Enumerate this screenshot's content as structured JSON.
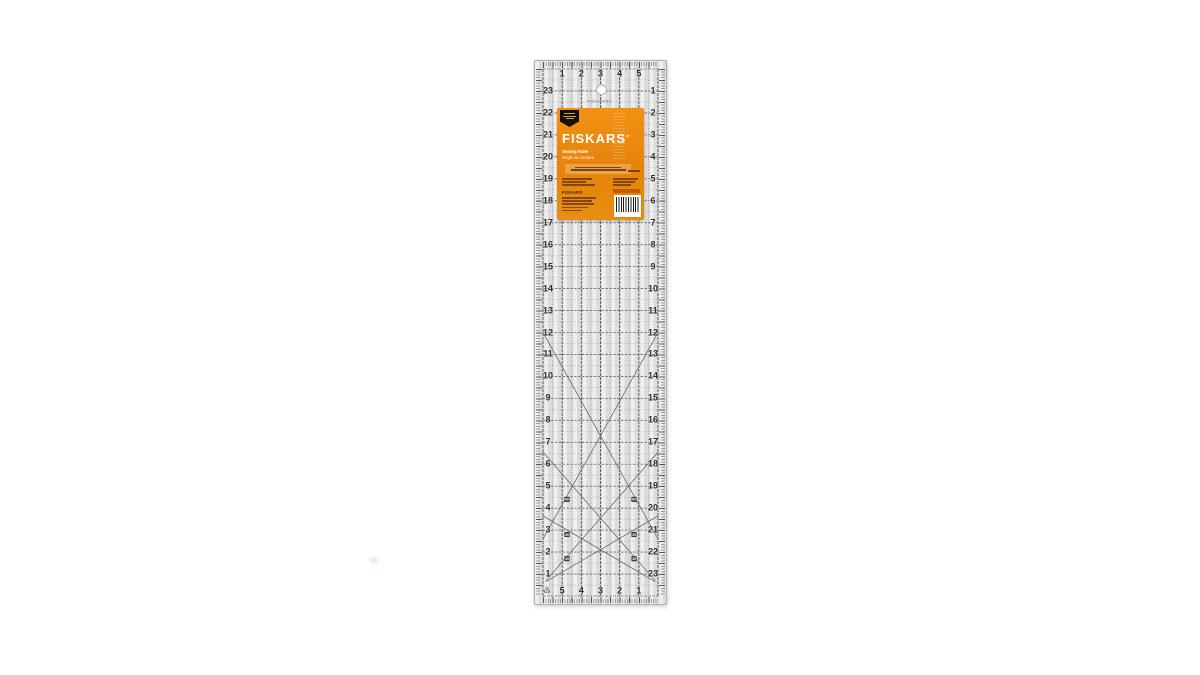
{
  "page": {
    "background": "#ffffff"
  },
  "ruler": {
    "brand_print": "FISKARS®",
    "top_numbers": [
      "1",
      "2",
      "3",
      "4",
      "5"
    ],
    "bottom_numbers": [
      "5",
      "4",
      "3",
      "2",
      "1"
    ],
    "left_numbers": [
      "23",
      "22",
      "21",
      "20",
      "19",
      "18",
      "17",
      "16",
      "15",
      "14",
      "13",
      "12",
      "11",
      "10",
      "9",
      "8",
      "7",
      "6",
      "5",
      "4",
      "3",
      "2",
      "1"
    ],
    "right_numbers": [
      "1",
      "2",
      "3",
      "4",
      "5",
      "6",
      "7",
      "8",
      "9",
      "10",
      "11",
      "12",
      "13",
      "14",
      "15",
      "16",
      "17",
      "18",
      "19",
      "20",
      "21",
      "22",
      "23"
    ],
    "angle_labels": [
      "60",
      "30",
      "45"
    ],
    "recycle_symbol": "♳",
    "body_color": "#dcdcdc",
    "line_color": "#565656"
  },
  "label": {
    "brand": "FISKARS",
    "registered": "®",
    "title_en": "Sewing Ruler",
    "title_fr": "Règle de couture",
    "small_brand": "FISKARS",
    "bg_color": "#ed8c10",
    "badge_color": "#17100a",
    "accent_chip_color": "#bd5f00"
  }
}
